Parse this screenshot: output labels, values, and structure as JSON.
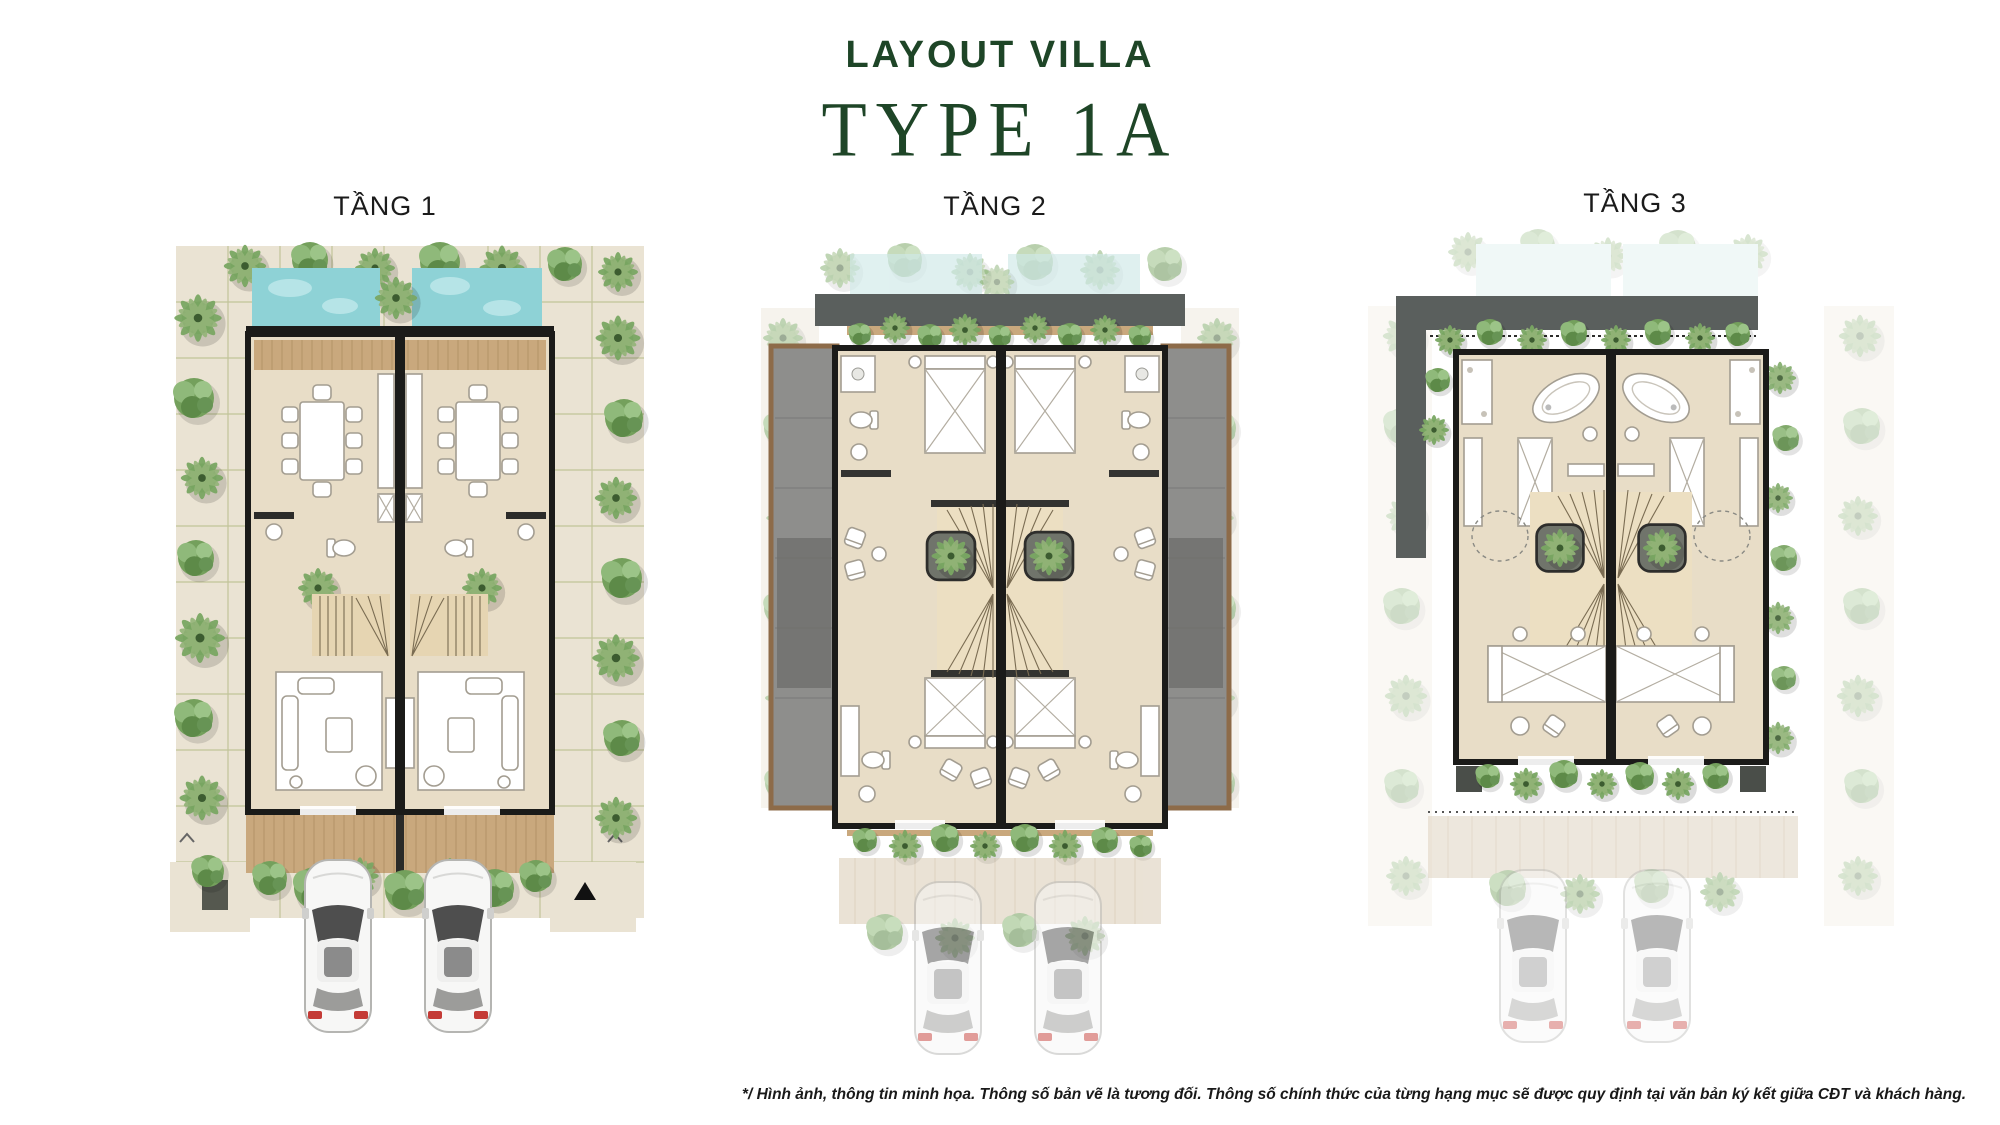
{
  "header": {
    "title": "LAYOUT VILLA",
    "subtitle": "TYPE 1A"
  },
  "floors": [
    {
      "id": "tang-1",
      "label": "TẦNG 1"
    },
    {
      "id": "tang-2",
      "label": "TẦNG 2"
    },
    {
      "id": "tang-3",
      "label": "TẦNG 3"
    }
  ],
  "footer": {
    "disclaimer": "*/ Hình ảnh, thông tin minh họa. Thông số bản vẽ là tương đối. Thông số chính thức của từng hạng mục sẽ được quy định tại văn bản ký kết giữa CĐT và khách hàng."
  },
  "colors": {
    "title_green": "#1e4527",
    "floor_label": "#1b1b1b",
    "pool_water": "#8ed2d6",
    "pool_ghost": "#cfe9e8",
    "wall": "#1b1b19",
    "floor_fill": "#e8ddc7",
    "deck_wood": "#c9a87d",
    "paving": "#eae3d3",
    "paving_grout": "#b3ba85",
    "roof_gray": "#5a5f5d",
    "balcony_gray": "#8e8e8c",
    "pergola_brown": "#8d6b49",
    "car_red": "#c43b36",
    "disclaimer": "#191919"
  }
}
